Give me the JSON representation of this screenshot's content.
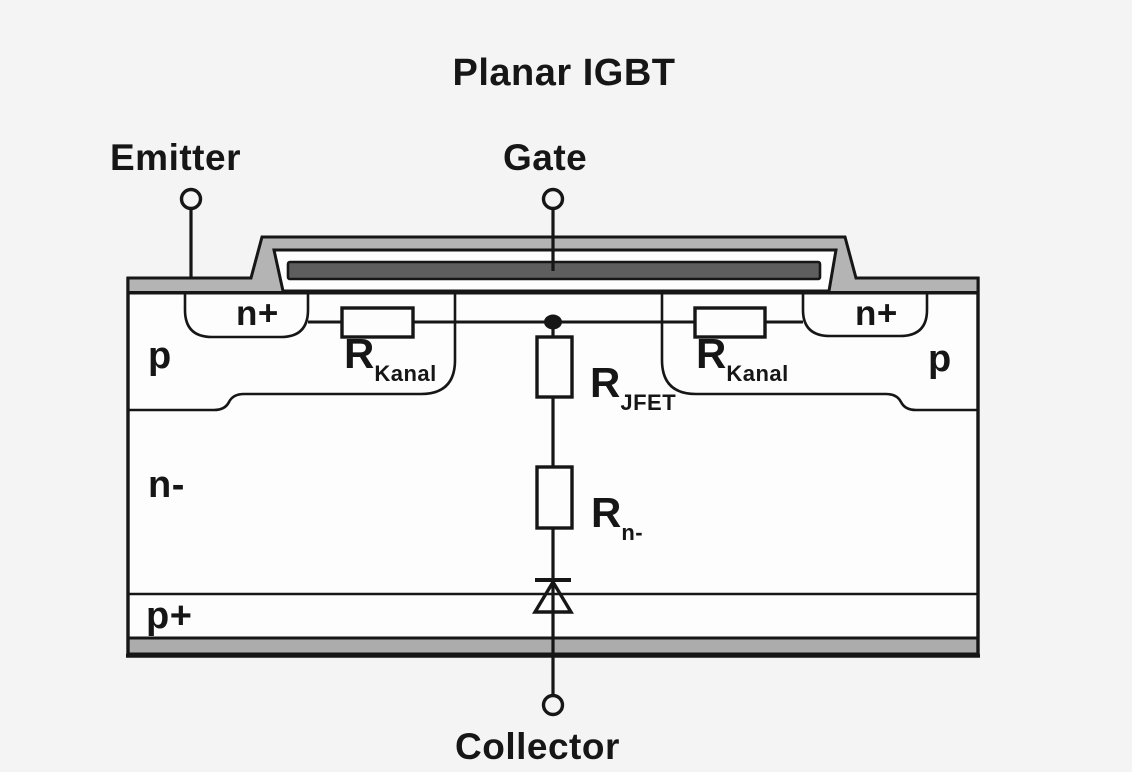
{
  "title": "Planar IGBT",
  "terminals": {
    "emitter": "Emitter",
    "gate": "Gate",
    "collector": "Collector"
  },
  "regions": {
    "n_plus_left": "n+",
    "n_plus_right": "n+",
    "p_left": "p",
    "p_right": "p",
    "n_drift": "n-",
    "p_plus": "p+"
  },
  "resistors": {
    "channel_left": {
      "base": "R",
      "sub": "Kanal"
    },
    "channel_right": {
      "base": "R",
      "sub": "Kanal"
    },
    "jfet": {
      "base": "R",
      "sub": "JFET"
    },
    "drift": {
      "base": "R",
      "sub": "n-"
    }
  },
  "colors": {
    "metal_light": "#b4b4b4",
    "gate_dark": "#5e5e5e",
    "collector_metal": "#acacac",
    "line": "#161616",
    "background": "#f4f4f5",
    "body_fill": "#fdfdfd"
  }
}
